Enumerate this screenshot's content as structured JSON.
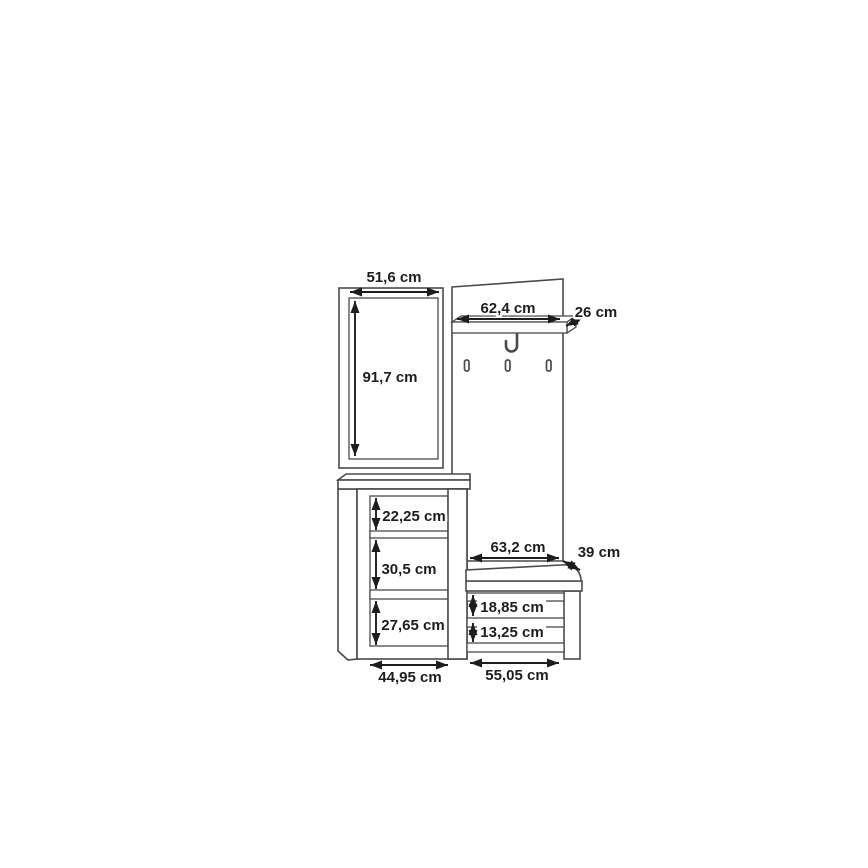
{
  "dimensions": {
    "mirror_width": "51,6 cm",
    "mirror_height": "91,7 cm",
    "shelf_width": "62,4 cm",
    "shelf_depth": "26 cm",
    "cabinet_compartment_top": "22,25 cm",
    "cabinet_compartment_middle": "30,5 cm",
    "cabinet_compartment_bottom": "27,65 cm",
    "bench_width": "63,2 cm",
    "bench_depth": "39 cm",
    "bench_shelf_gap_upper": "18,85 cm",
    "bench_shelf_gap_lower": "13,25 cm",
    "cabinet_base_width": "44,95 cm",
    "bench_base_width": "55,05 cm"
  },
  "colors": {
    "background": "#ffffff",
    "furniture_line": "#4a4a4a",
    "dimension_line": "#1d1d1d",
    "label_text": "#1d1d1d"
  }
}
